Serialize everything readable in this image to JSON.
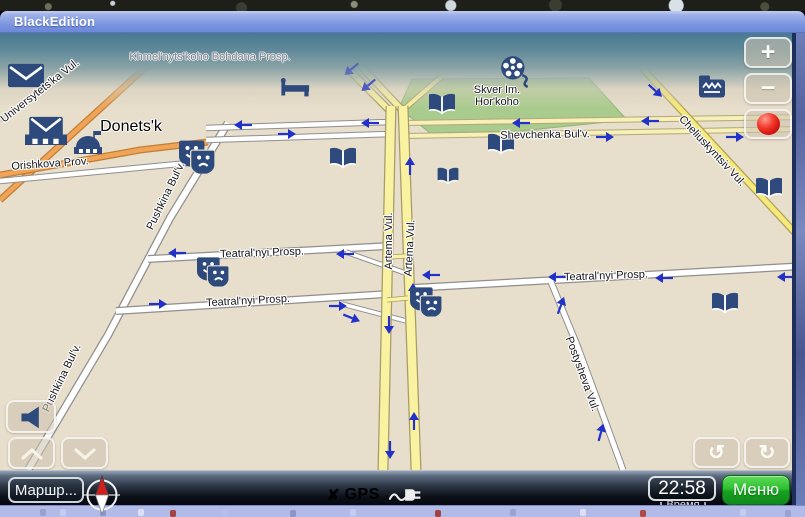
{
  "window": {
    "title": "BlackEdition"
  },
  "map": {
    "city_label": "Donets'k",
    "park_label": [
      "Skver Im.",
      "Hor'koho"
    ],
    "street_labels": [
      {
        "text": "Khmel'nyts'koho Bohdana Prosp.",
        "x": 210,
        "y": 57,
        "rot": 0,
        "style": "muted"
      },
      {
        "text": "Universytets'ka Vul.",
        "x": 40,
        "y": 91,
        "rot": -38
      },
      {
        "text": "Orishkova Prov.",
        "x": 50,
        "y": 164,
        "rot": -4
      },
      {
        "text": "Pushkina Bul'v.",
        "x": 166,
        "y": 196,
        "rot": -64
      },
      {
        "text": "Pushkina Bul'v.",
        "x": 62,
        "y": 378,
        "rot": -64
      },
      {
        "text": "Teatral'nyi Prosp.",
        "x": 262,
        "y": 253,
        "rot": -2
      },
      {
        "text": "Teatral'nyi Prosp.",
        "x": 248,
        "y": 301,
        "rot": -3
      },
      {
        "text": "Teatral'nyi Prosp.",
        "x": 606,
        "y": 276,
        "rot": -2
      },
      {
        "text": "Artema Vul.",
        "x": 389,
        "y": 241,
        "rot": -90
      },
      {
        "text": "Artema Vul.",
        "x": 410,
        "y": 248,
        "rot": -87
      },
      {
        "text": "Shevchenka Bul'v.",
        "x": 545,
        "y": 135,
        "rot": -1
      },
      {
        "text": "Cheliuskyntsiv Vul.",
        "x": 712,
        "y": 151,
        "rot": 47
      },
      {
        "text": "Postysheva Vul.",
        "x": 582,
        "y": 374,
        "rot": 70
      }
    ],
    "poi_icons": [
      {
        "type": "mail-icon",
        "x": 26,
        "y": 78,
        "w": 36
      },
      {
        "type": "postoffice-icon",
        "x": 46,
        "y": 136,
        "w": 42
      },
      {
        "type": "government-icon",
        "x": 88,
        "y": 146,
        "w": 30
      },
      {
        "type": "hotel-icon",
        "x": 295,
        "y": 90,
        "w": 30
      },
      {
        "type": "cinema-icon",
        "x": 516,
        "y": 74,
        "w": 34
      },
      {
        "type": "fax-icon",
        "x": 712,
        "y": 91,
        "w": 30
      },
      {
        "type": "theater-icon",
        "x": 197,
        "y": 159,
        "w": 36
      },
      {
        "type": "theater-icon",
        "x": 213,
        "y": 274,
        "w": 32
      },
      {
        "type": "theater-icon",
        "x": 426,
        "y": 304,
        "w": 32
      },
      {
        "type": "book-icon",
        "x": 343,
        "y": 160,
        "w": 30
      },
      {
        "type": "book-icon",
        "x": 442,
        "y": 106,
        "w": 30
      },
      {
        "type": "book-icon",
        "x": 501,
        "y": 146,
        "w": 30
      },
      {
        "type": "book-icon",
        "x": 448,
        "y": 178,
        "w": 24
      },
      {
        "type": "book-icon",
        "x": 769,
        "y": 190,
        "w": 30
      },
      {
        "type": "book-icon",
        "x": 725,
        "y": 305,
        "w": 30
      }
    ],
    "oneway_arrows": [
      {
        "x": 243,
        "y": 126,
        "rot": 180
      },
      {
        "x": 370,
        "y": 124,
        "rot": 180
      },
      {
        "x": 521,
        "y": 124,
        "rot": 180
      },
      {
        "x": 650,
        "y": 122,
        "rot": 180
      },
      {
        "x": 287,
        "y": 133,
        "rot": 0
      },
      {
        "x": 605,
        "y": 136,
        "rot": 0
      },
      {
        "x": 735,
        "y": 136,
        "rot": 0
      },
      {
        "x": 177,
        "y": 254,
        "rot": 180
      },
      {
        "x": 345,
        "y": 255,
        "rot": 180
      },
      {
        "x": 431,
        "y": 276,
        "rot": 180
      },
      {
        "x": 557,
        "y": 278,
        "rot": 180
      },
      {
        "x": 664,
        "y": 279,
        "rot": 180
      },
      {
        "x": 786,
        "y": 278,
        "rot": 180
      },
      {
        "x": 158,
        "y": 303,
        "rot": 0
      },
      {
        "x": 338,
        "y": 305,
        "rot": 0
      },
      {
        "x": 352,
        "y": 317,
        "rot": 22
      },
      {
        "x": 390,
        "y": 325,
        "rot": 90
      },
      {
        "x": 391,
        "y": 450,
        "rot": 90
      },
      {
        "x": 413,
        "y": 421,
        "rot": -90
      },
      {
        "x": 412,
        "y": 292,
        "rot": -90
      },
      {
        "x": 409,
        "y": 166,
        "rot": -90
      },
      {
        "x": 352,
        "y": 70,
        "rot": 140,
        "op": 0.5
      },
      {
        "x": 369,
        "y": 86,
        "rot": 140,
        "op": 0.75
      },
      {
        "x": 656,
        "y": 90,
        "rot": 42
      },
      {
        "x": 560,
        "y": 305,
        "rot": -70
      },
      {
        "x": 600,
        "y": 432,
        "rot": -75
      }
    ]
  },
  "map_controls": {
    "zoom_in_label": "+",
    "zoom_out_label": "−",
    "rotate_ccw_glyph": "↺",
    "rotate_cw_glyph": "↻"
  },
  "bottom_bar": {
    "route_button_label": "Маршр...",
    "gps_x_mark": "✘",
    "gps_label": "GPS",
    "time_value": "22:58",
    "time_caption": "Время",
    "menu_button_label": "Меню"
  },
  "colors": {
    "titlebar_blue": "#7e97e0",
    "sky_teal": "#497a90",
    "map_beige": "#e7decb",
    "park_green": "#a9cb8d",
    "road_yellow": "#f9f2a0",
    "road_pale_yellow": "#f7f0b8",
    "road_orange": "#f0a458",
    "road_white": "#ffffff",
    "poi_navy": "#2e4a7d",
    "arrow_blue": "#2232c8",
    "menu_green": "#2db32d",
    "gps_red": "#e31515",
    "record_red": "#d61414"
  }
}
